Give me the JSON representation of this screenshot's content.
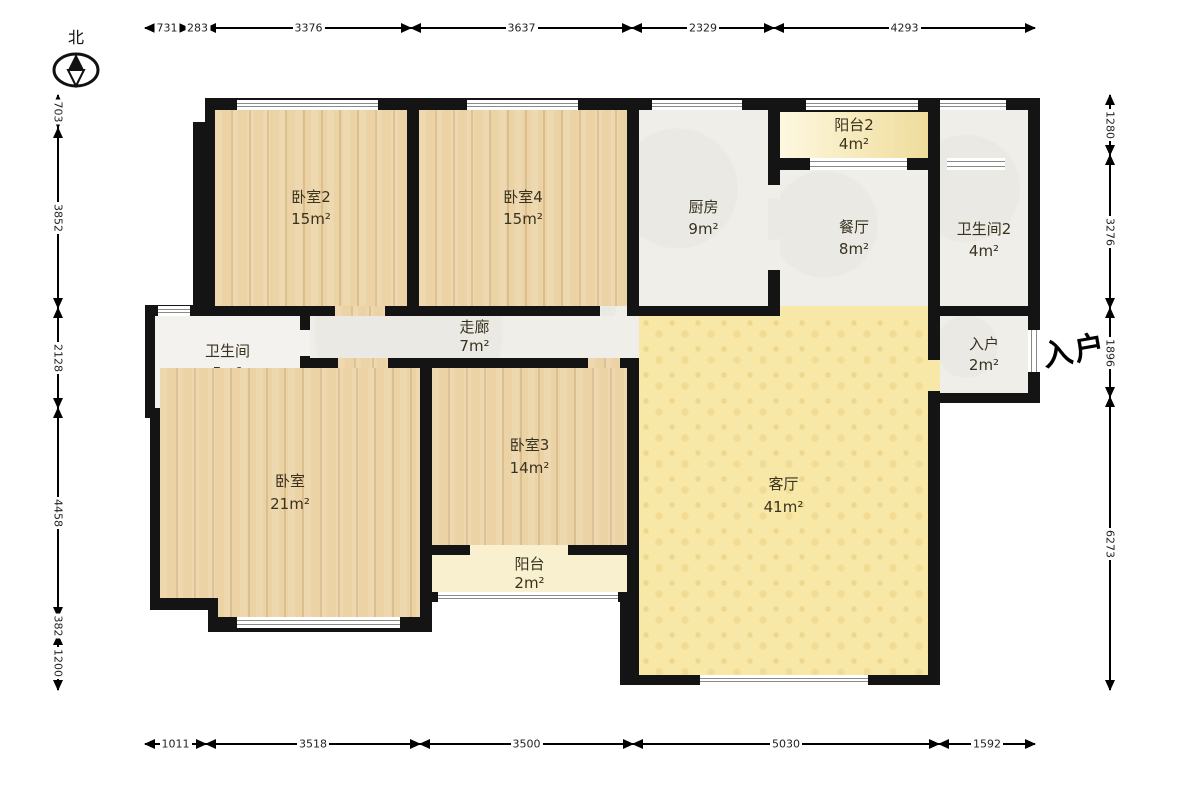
{
  "north_label": "北",
  "entrance_marker": "入户",
  "rooms": {
    "bedroom2": {
      "name": "卧室2",
      "area": "15m²"
    },
    "bedroom4": {
      "name": "卧室4",
      "area": "15m²"
    },
    "kitchen": {
      "name": "厨房",
      "area": "9m²"
    },
    "balcony2": {
      "name": "阳台2",
      "area": "4m²"
    },
    "dining": {
      "name": "餐厅",
      "area": "8m²"
    },
    "bathroom2": {
      "name": "卫生间2",
      "area": "4m²"
    },
    "bathroom": {
      "name": "卫生间",
      "area": "5m²"
    },
    "corridor": {
      "name": "走廊",
      "area": "7m²"
    },
    "entry": {
      "name": "入户",
      "area": "2m²"
    },
    "bedroom": {
      "name": "卧室",
      "area": "21m²"
    },
    "bedroom3": {
      "name": "卧室3",
      "area": "14m²"
    },
    "balcony": {
      "name": "阳台",
      "area": "2m²"
    },
    "living": {
      "name": "客厅",
      "area": "41m²"
    }
  },
  "dimensions_mm": {
    "top": [
      731,
      283,
      3376,
      3637,
      2329,
      4293
    ],
    "bottom": [
      1011,
      3518,
      3500,
      5030,
      1592
    ],
    "left": [
      703,
      3852,
      2128,
      4458,
      382,
      1200
    ],
    "right": [
      1280,
      3276,
      1896,
      6273
    ]
  },
  "colors": {
    "wall": "#141414",
    "wood_floor": "#ecd3a5",
    "living_floor": "#f8e8a8",
    "balcony_floor": "#f6ecc6",
    "tile_floor": "#efeee9"
  }
}
